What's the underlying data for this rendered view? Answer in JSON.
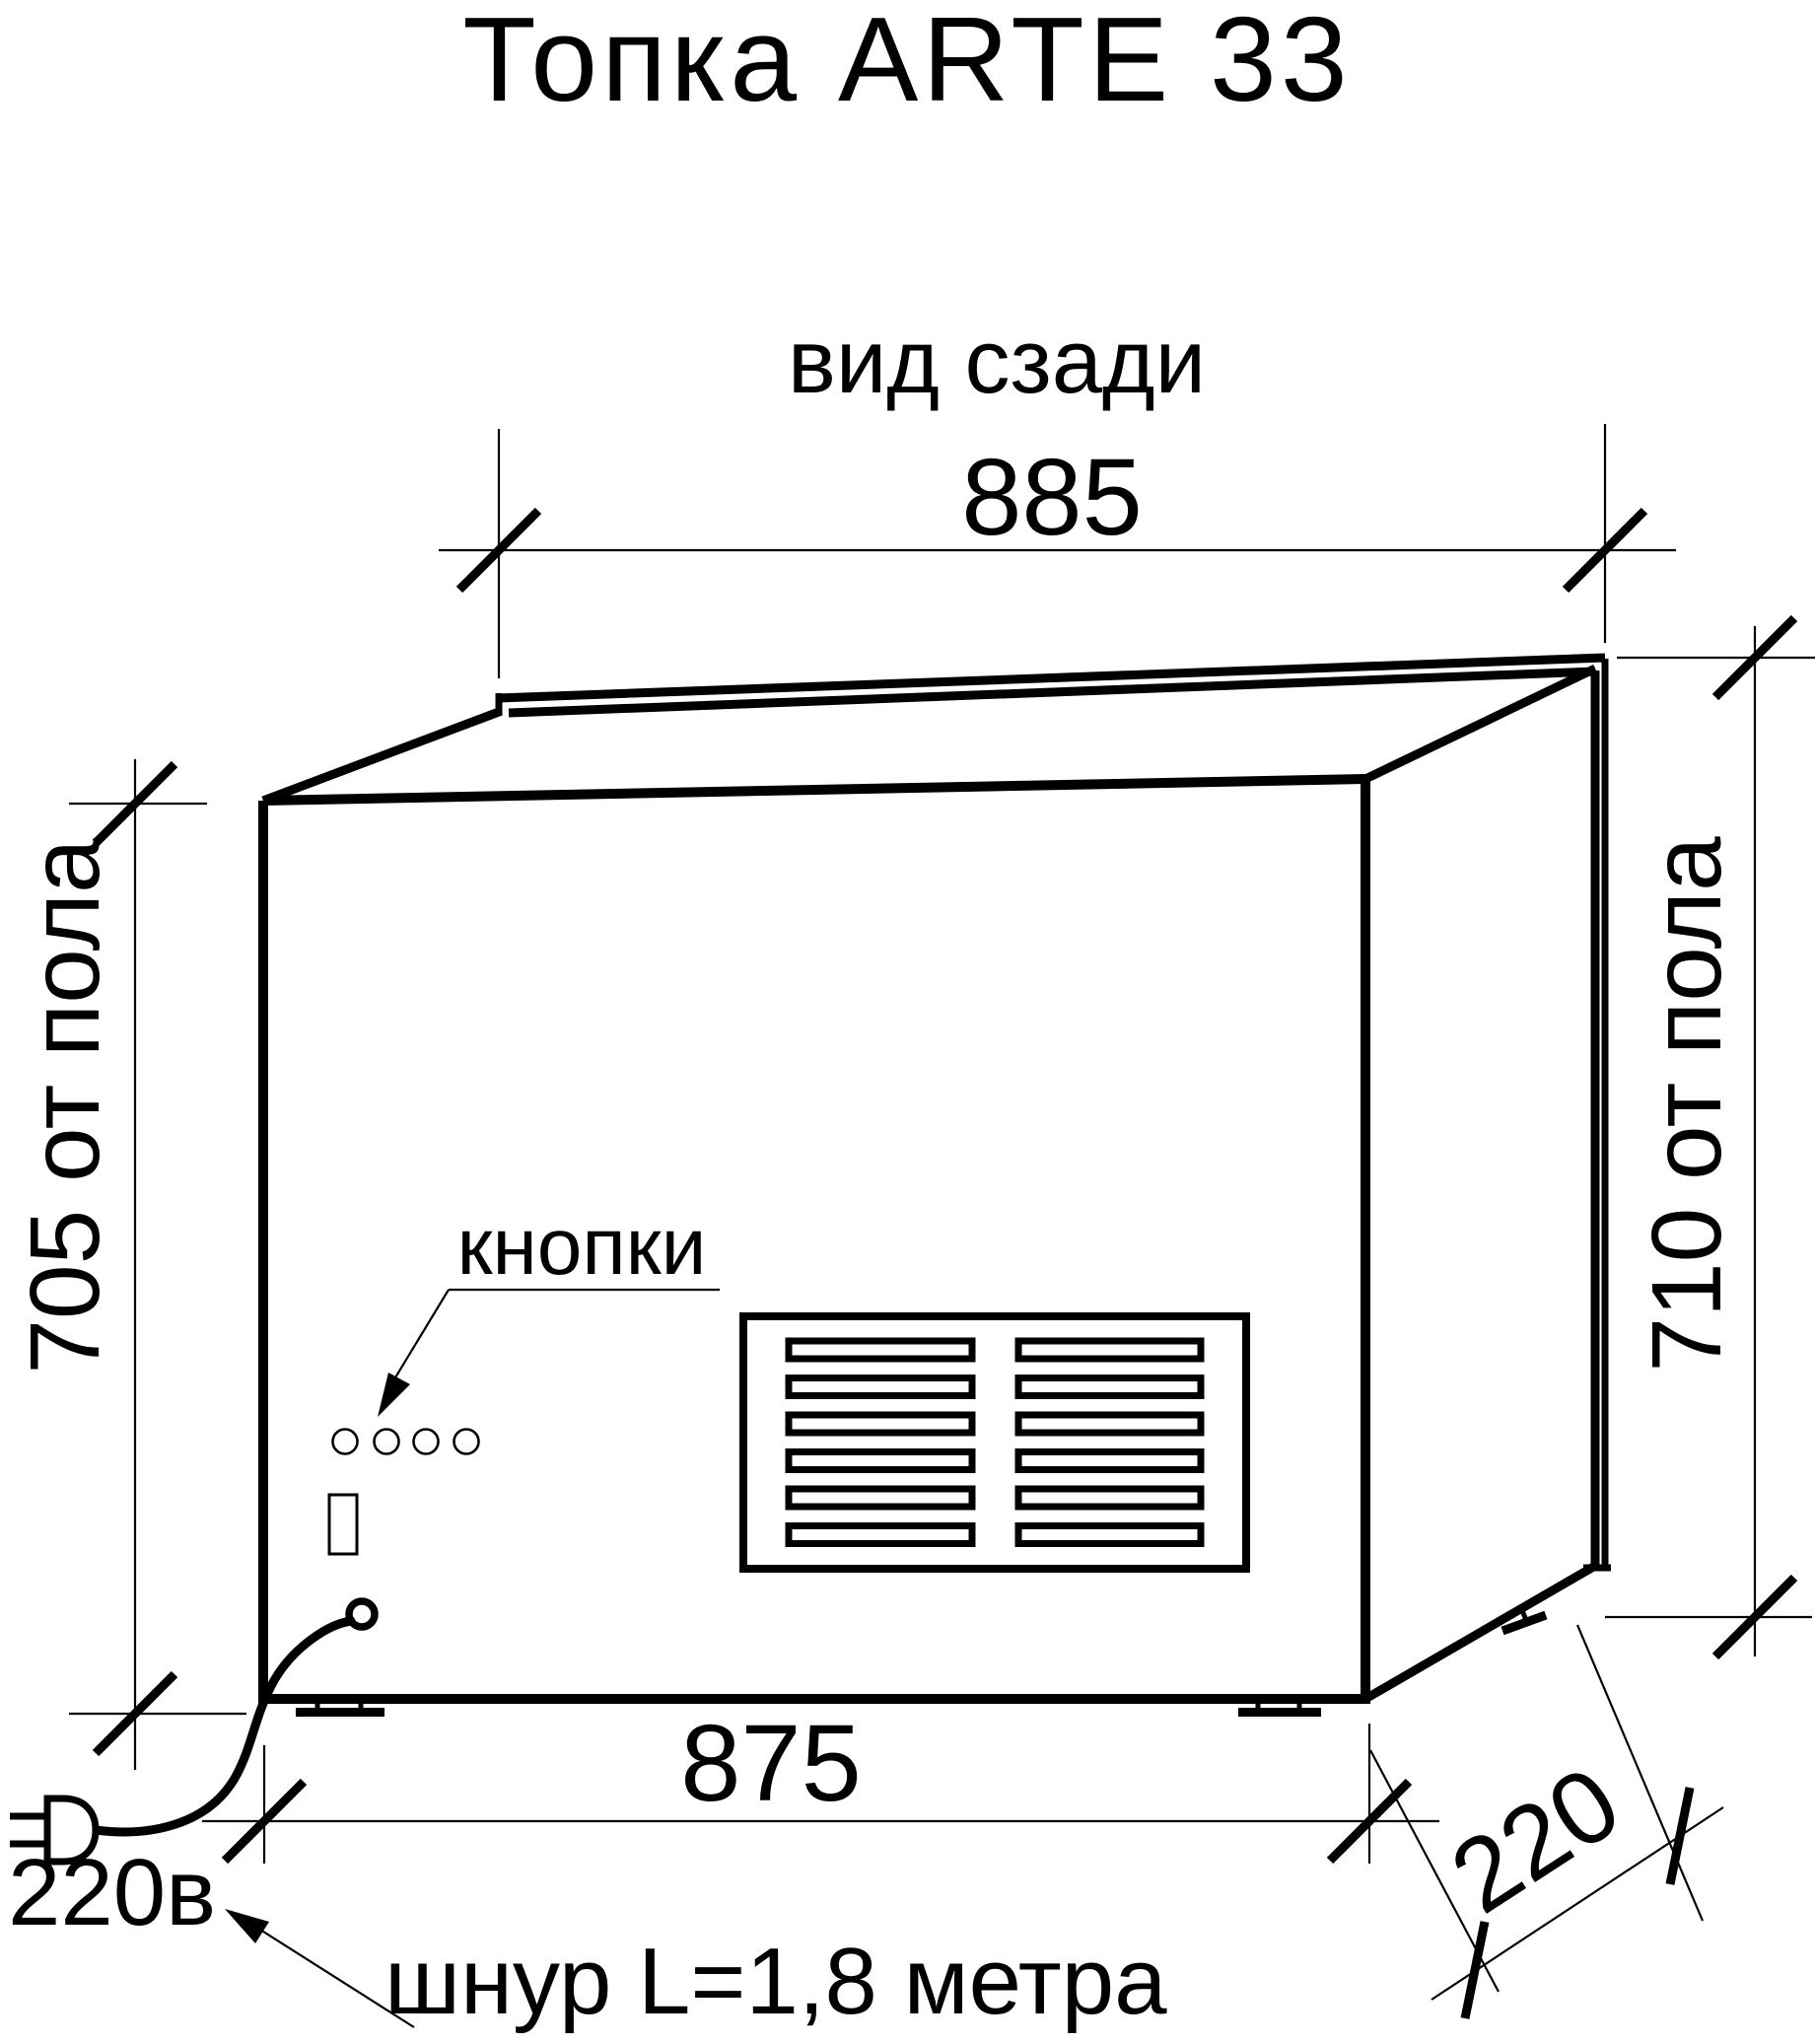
{
  "title": "Топка ARTE 33",
  "view_label": "вид сзади",
  "dimensions": {
    "top_width": "885",
    "bottom_width": "875",
    "left_height": "705 от пола",
    "right_height": "710 от пола",
    "depth": "220"
  },
  "annotations": {
    "buttons_label": "кнопки",
    "power_label": "220в",
    "cord_label": "шнур L=1,8 метра"
  },
  "figure": {
    "buttons_count": 4,
    "grille_rows": 6,
    "grille_columns": 2
  },
  "colors": {
    "line": "#000000",
    "background": "#ffffff"
  }
}
